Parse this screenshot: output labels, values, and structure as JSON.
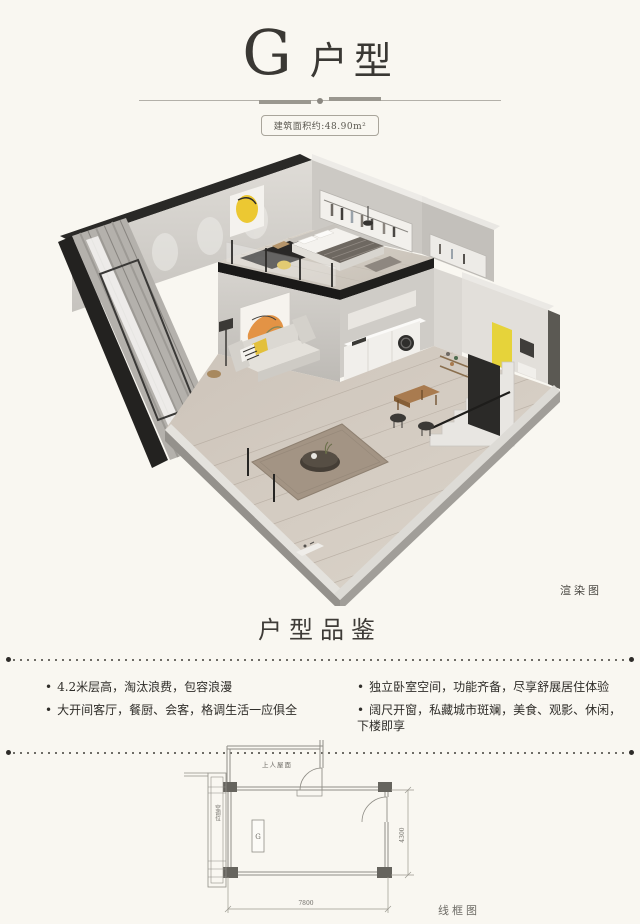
{
  "header": {
    "unit_letter": "G",
    "unit_word": "户型",
    "area_badge": "建筑面积约:48.90m²"
  },
  "render": {
    "caption": "渲染图"
  },
  "section": {
    "title": "户型品鉴",
    "bullets_left": [
      "4.2米层高，淘汰浪费，包容浪漫",
      "大开间客厅，餐厨、会客，格调生活一应俱全"
    ],
    "bullets_right": [
      "独立卧室空间，功能齐备，尽享舒展居住体验",
      "阔尺开窗，私藏城市斑斓，美食、观影、休闲，下楼即享"
    ]
  },
  "floorplan": {
    "roof_label": "上人屋面",
    "unit_label": "G",
    "equip_label": "空调位",
    "dim_right": "4300",
    "dim_bottom": "7800",
    "caption": "线框图"
  },
  "colors": {
    "paper": "#f9f7f1",
    "accent_yellow": "#e6c93a",
    "accent_orange": "#e28d3b",
    "ink": "#3a3834"
  }
}
